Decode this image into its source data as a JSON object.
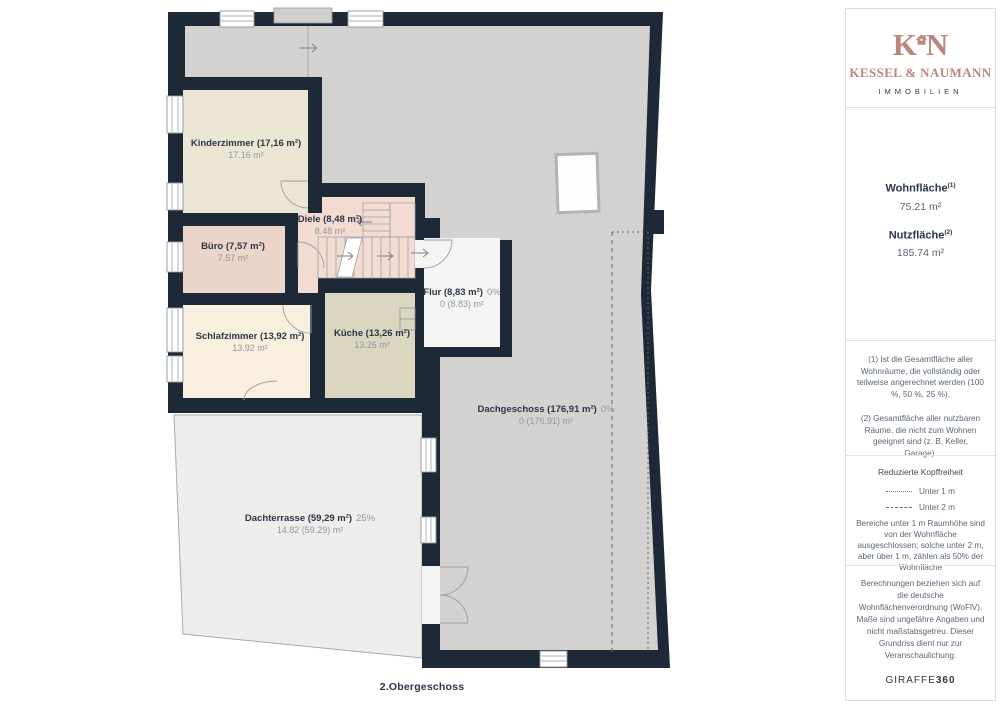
{
  "plan": {
    "floor_label": "2.Obergeschoss",
    "rooms": [
      {
        "id": "kinderzimmer",
        "name_label": "Kinderzimmer (17,16 m²)",
        "sub": "17.16 m²"
      },
      {
        "id": "buero",
        "name_label": "Büro (7,57 m²)",
        "sub": "7.57 m²"
      },
      {
        "id": "diele",
        "name_label": "Diele (8,48 m²)",
        "sub": "8.48 m²"
      },
      {
        "id": "schlafzimmer",
        "name_label": "Schlafzimmer (13,92 m²)",
        "sub": "13.92 m²"
      },
      {
        "id": "kueche",
        "name_label": "Küche (13,26 m²)",
        "sub": "13.26 m²"
      },
      {
        "id": "flur",
        "name_label": "Flur (8,83 m²)",
        "pct": "0%",
        "sub": "0 (8.83) m²"
      },
      {
        "id": "dachgeschoss",
        "name_label": "Dachgeschoss (176,91 m²)",
        "pct": "0%",
        "sub": "0 (176.91) m²"
      },
      {
        "id": "dachterrasse",
        "name_label": "Dachterrasse (59,29 m²)",
        "pct": "25%",
        "sub": "14.82 (59.29) m²"
      }
    ],
    "colors": {
      "wall": "#1e2937",
      "attic_gray": "#d3d2d0",
      "terrace": "#eeedec",
      "kinderzimmer": "#ebe6d4",
      "schlafzimmer": "#f8efdf",
      "buero": "#ebd4ca",
      "diele": "#f3dbd1",
      "kueche": "#dbd6bf",
      "flur": "#f4f4f3"
    }
  },
  "sidebar": {
    "brand": {
      "initial_left": "K",
      "initial_right": "N",
      "name": "KESSEL & NAUMANN",
      "subtitle": "IMMOBILIEN",
      "accent": "#bb867e"
    },
    "metrics": {
      "wohnflaeche_label": "Wohnfläche",
      "wohnflaeche_sup": "(1)",
      "wohnflaeche_value": "75.21 m²",
      "nutzflaeche_label": "Nutzfläche",
      "nutzflaeche_sup": "(2)",
      "nutzflaeche_value": "185.74 m²"
    },
    "footnotes": {
      "note1": "(1) Ist die Gesamtfläche aller Wohnräume, die vollständig oder teilweise angerechnet werden (100 %, 50 %, 25 %).",
      "note2": "(2) Gesamtfläche aller nutzbaren Räume, die nicht zum Wohnen geeignet sind (z. B. Keller, Garage)."
    },
    "headroom": {
      "title": "Reduzierte Kopffreiheit",
      "legend_under_1m": "Unter 1 m",
      "legend_under_2m": "Unter 2 m",
      "description": "Bereiche unter 1 m Raumhöhe sind von der Wohnfläche ausgeschlossen; solche unter 2 m, aber über 1 m, zählen als 50% der Wohnfläche"
    },
    "disclaimer": "Berechnungen beziehen sich auf die deutsche Wohnflächenverordnung (WoFlV). Maße sind ungefähre Angaben und nicht maßstabsgetreu. Dieser Grundriss dient nur zur Veranschaulichung.",
    "watermark": {
      "brand": "GIRAFFE",
      "suffix": "360"
    }
  }
}
